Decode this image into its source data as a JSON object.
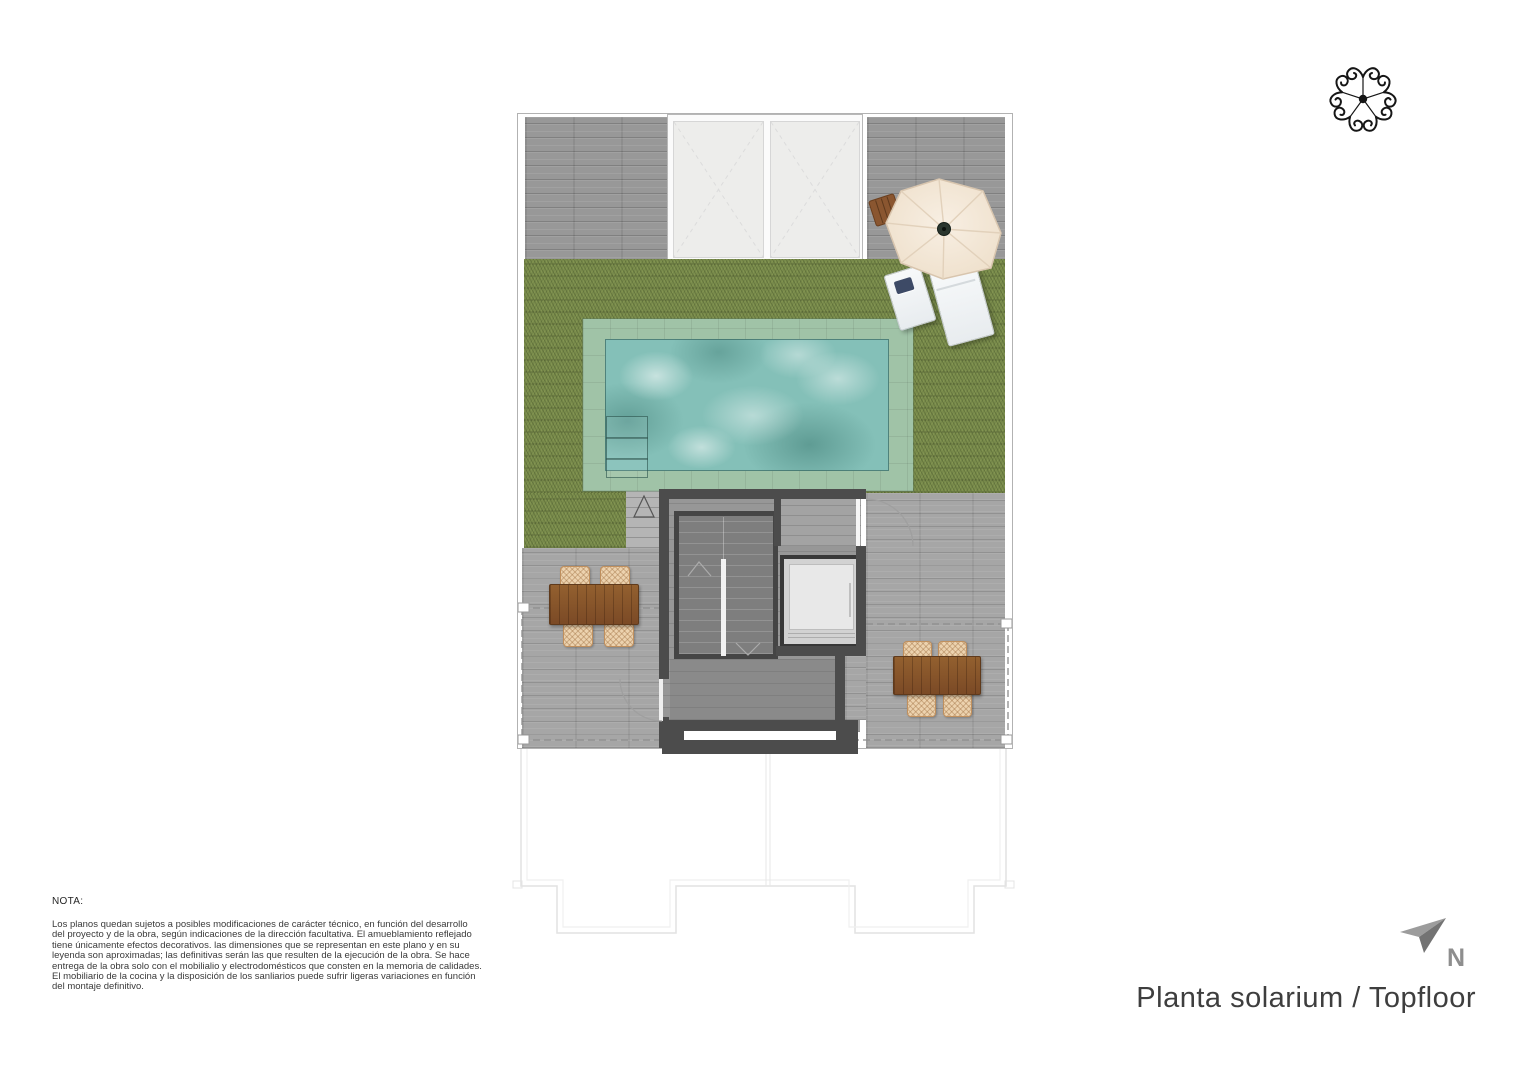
{
  "title": {
    "label": "Planta solarium / Topfloor"
  },
  "compass": {
    "label": "N"
  },
  "note": {
    "heading": "NOTA:",
    "body": "Los planos quedan sujetos a posibles modificaciones de carácter técnico, en función del desarrollo\ndel proyecto y de la obra, según indicaciones de la dirección facultativa. El amueblamiento reflejado\ntiene únicamente efectos decorativos. las dimensiones que se representan en este plano y en su\nleyenda son aproximadas; las definitivas serán las que resulten de la ejecución de la obra. Se hace\nentrega de la obra solo con el mobilialio y electrodomésticos que consten en la memoria de calidades.\nEl mobiliario de la cocina y la disposición de los sanliarios puede sufrir ligeras variaciones en función\ndel montaje definitivo."
  },
  "icons": {
    "logo": "rosette-ornament",
    "compass": "north-arrow",
    "parasol": "umbrella-top-view"
  },
  "colors": {
    "lawn": "#77894b",
    "pool_water": "#84c0b8",
    "pool_border": "#a0c3a7",
    "deck": "#a6a6a6",
    "walls": "#4c4c4c",
    "wood_table": "#8a5630",
    "wicker_chair": "#ecd2ae",
    "umbrella": "#f3e7d8",
    "compass_gray": "#8e8e8e"
  }
}
